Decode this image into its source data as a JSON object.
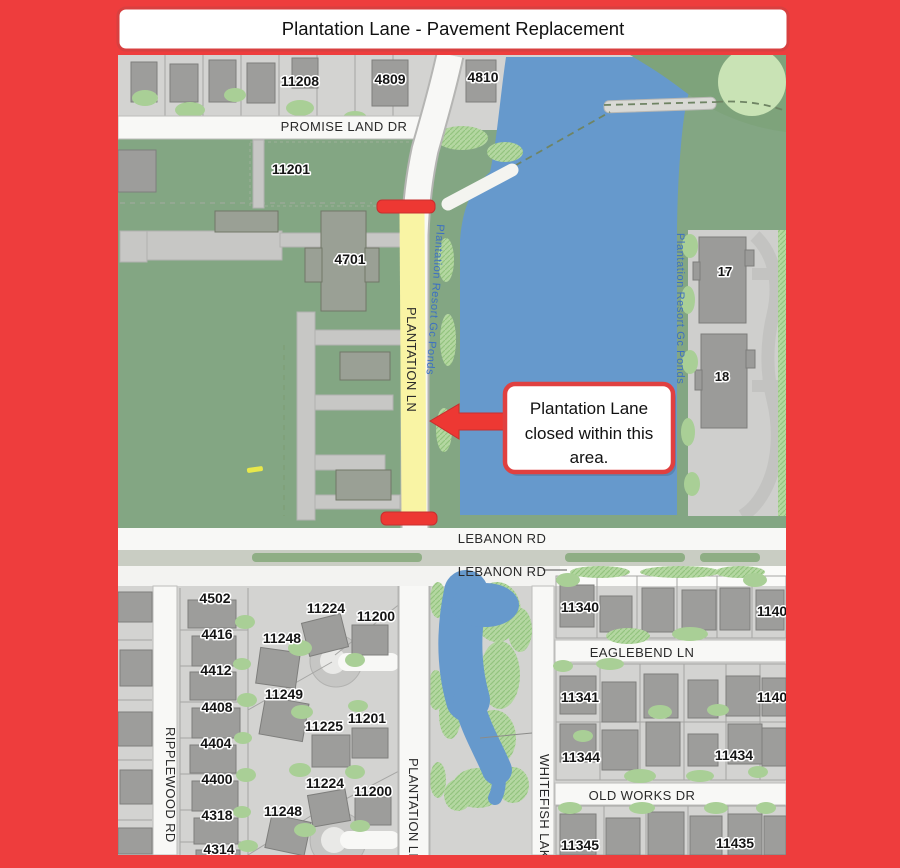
{
  "title": "Plantation Lane - Pavement Replacement",
  "callout": {
    "lines": [
      "Plantation Lane",
      "closed within this",
      "area."
    ]
  },
  "streets": {
    "promise_land_dr": "PROMISE LAND DR",
    "lebanon_rd_north": "LEBANON RD",
    "lebanon_rd_south": "LEBANON RD",
    "eaglebend_ln": "EAGLEBEND LN",
    "old_works_dr": "OLD WORKS DR",
    "ripplewood_rd": "RIPPLEWOOD RD",
    "whitefish_lake": "WHITEFISH LAKE",
    "plantation_ln_closed": "PLANTATION LN",
    "plantation_ln_south": "PLANTATION LN"
  },
  "water_labels": {
    "west_pond": "Plantation Resort Gc Ponds",
    "east_pond": "Plantation Resort Gc Ponds"
  },
  "addresses": {
    "h11208": "11208",
    "h4809": "4809",
    "h4810": "4810",
    "h11201_top": "11201",
    "h4701": "4701",
    "b17": "17",
    "b18": "18",
    "h4502": "4502",
    "h4416": "4416",
    "h4412": "4412",
    "h4408": "4408",
    "h4404": "4404",
    "h4400": "4400",
    "h4318": "4318",
    "h4314": "4314",
    "h11224_n": "11224",
    "h11200_n": "11200",
    "h11248_n": "11248",
    "h11249": "11249",
    "h11225": "11225",
    "h11201_s": "11201",
    "h11224_s": "11224",
    "h11200_s": "11200",
    "h11248_s": "11248",
    "h11340": "11340",
    "h1140_r1": "1140",
    "h11341": "11341",
    "h1140_r2": "1140",
    "h11344": "11344",
    "h11434": "11434",
    "h11345": "11345",
    "h11435": "11435"
  },
  "colors": {
    "frame_red": "#ee3d3d",
    "closure_red": "#ed3833",
    "water_blue": "#6699cc",
    "field_green": "#83a683",
    "highlight_yellow": "#f9f4a4",
    "callout_border_red": "#e04040"
  }
}
